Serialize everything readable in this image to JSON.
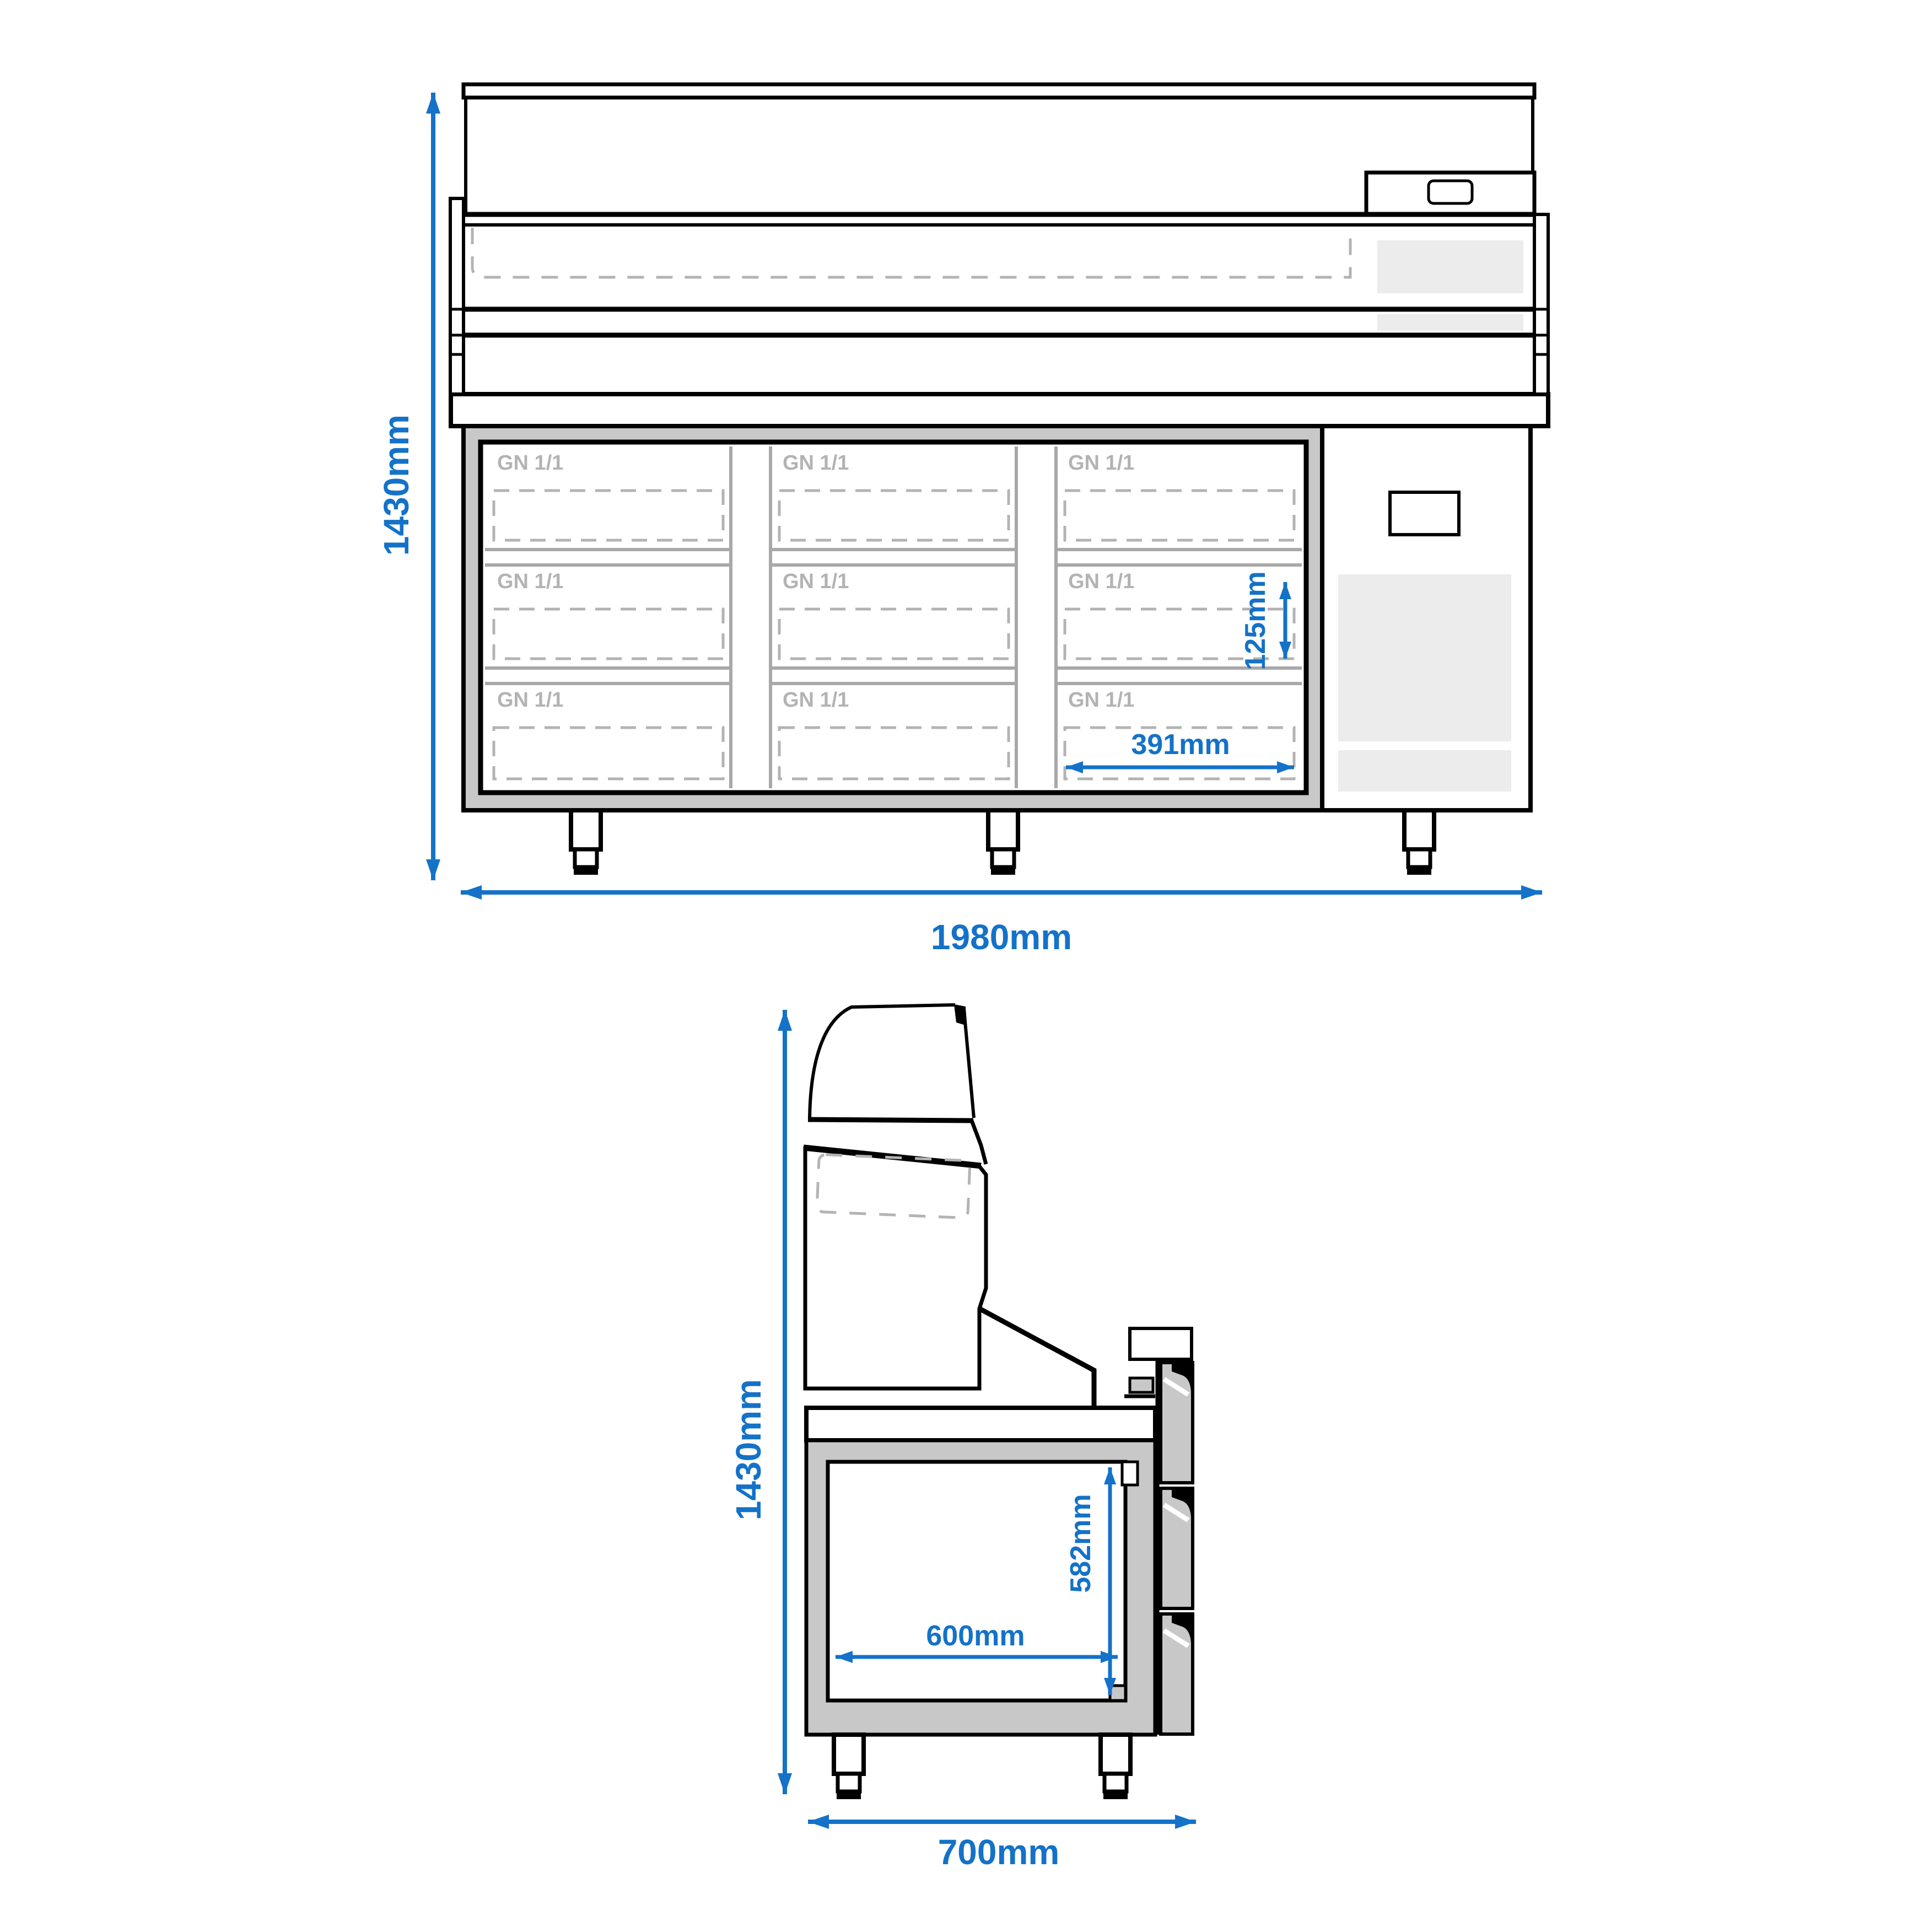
{
  "drawing": {
    "type": "technical-dimension-drawing",
    "subject": "refrigerated pizza prep counter with glass display top",
    "colors": {
      "dimension_blue": "#1472c8",
      "outline_black": "#000000",
      "frame_gray": "#c8c8c8",
      "vent_gray": "#ececec",
      "label_gray": "#b3b3b3"
    },
    "front_view": {
      "compartments": [
        {
          "label": "GN 1/1"
        },
        {
          "label": "GN 1/1"
        },
        {
          "label": "GN 1/1"
        },
        {
          "label": "GN 1/1"
        },
        {
          "label": "GN 1/1"
        },
        {
          "label": "GN 1/1"
        },
        {
          "label": "GN 1/1"
        },
        {
          "label": "GN 1/1"
        },
        {
          "label": "GN 1/1"
        }
      ],
      "dimensions": {
        "height": "1430mm",
        "width": "1980mm",
        "pan_height": "125mm",
        "pan_width": "391mm"
      }
    },
    "side_view": {
      "dimensions": {
        "height": "1430mm",
        "depth": "700mm",
        "inner_width": "600mm",
        "inner_height": "582mm"
      }
    }
  }
}
